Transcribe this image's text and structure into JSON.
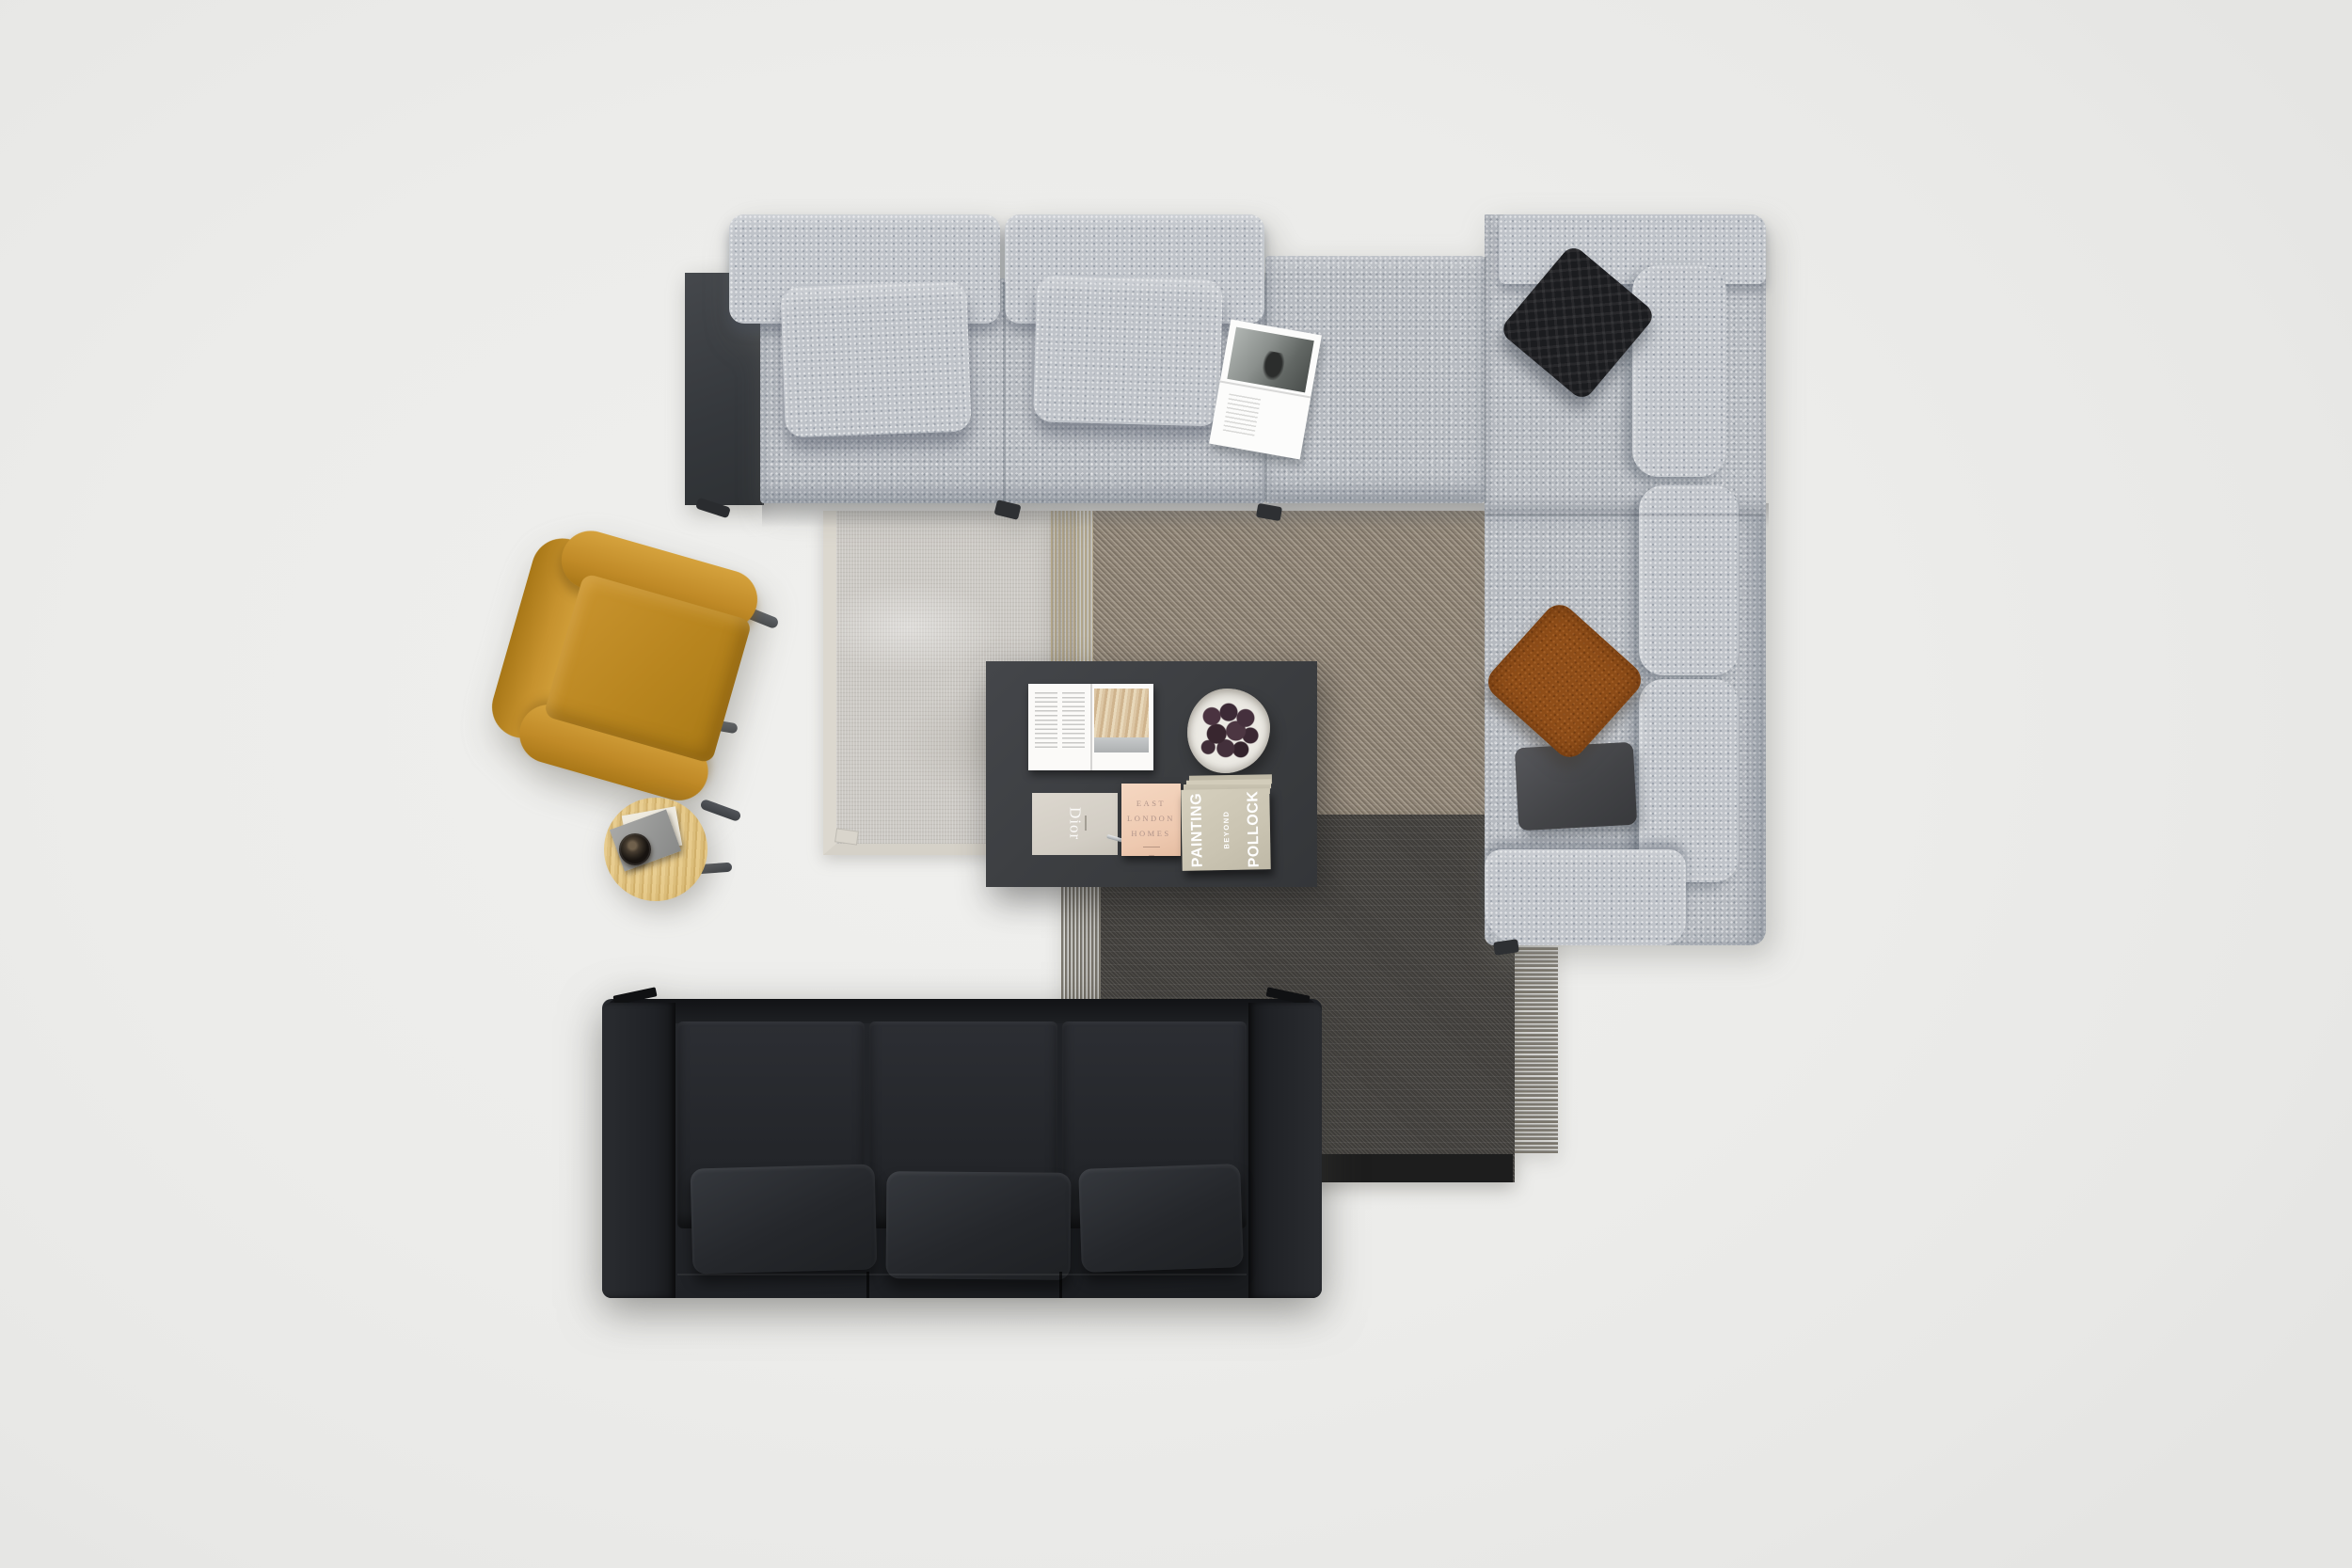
{
  "scene": {
    "description": "Top-down photo of a staged living room: gray boucle sectional with pillows and magazine, layered rugs, dark coffee table with books and fig bowl, mustard armchair, round oak side table, black leather three-seat sofa",
    "floor_color": "#ebebe9"
  },
  "coffee_table": {
    "books": {
      "dior_title": "Dior",
      "east_london_homes": {
        "line1": "EAST",
        "line2": "LONDON",
        "line3": "HOMES"
      },
      "painting_beyond_pollock": {
        "line1": "PAINTING",
        "line2": "BEYOND",
        "line3": "POLLOCK"
      }
    }
  },
  "palette": {
    "floor": "#ebebe9",
    "sectional_fabric": "#b6bac0",
    "black_quilted_pillow": "#1b1c1f",
    "rust_pillow": "#8e4d18",
    "charcoal_pillow": "#4a4c4f",
    "console_panel": "#3a3d41",
    "light_rug": "#cbc8c3",
    "taupe_rug": "#8e8375",
    "charcoal_rug": "#3f3d3a",
    "coffee_table": "#3d3f42",
    "armchair": "#c08a2d",
    "side_table_wood": "#e2c78d",
    "leather_sofa": "#202226"
  }
}
